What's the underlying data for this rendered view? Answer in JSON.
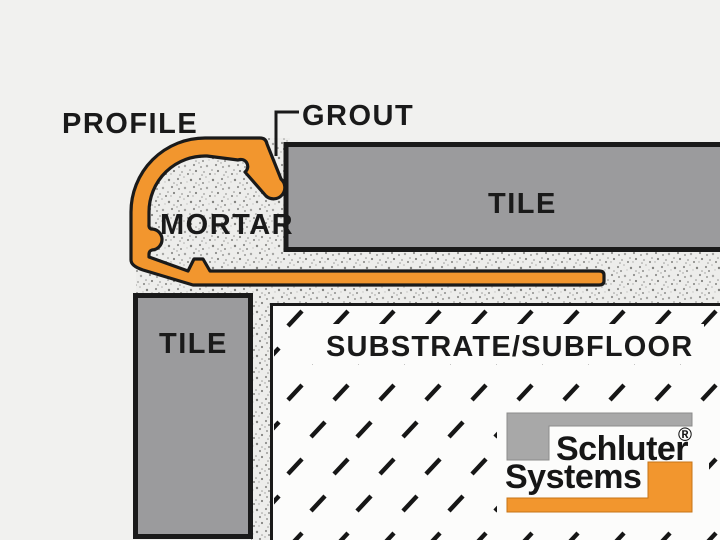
{
  "title": "Tile edge profile installation cross-section diagram",
  "labels": {
    "profile": "PROFILE",
    "grout": "GROUT",
    "mortar": "MORTAR",
    "tile_top": "TILE",
    "tile_left": "TILE",
    "substrate": "SUBSTRATE/SUBFLOOR"
  },
  "logo": {
    "line1": "Schluter",
    "line2": "Systems",
    "registered_mark": "®"
  },
  "colors": {
    "background": "#F1F1EF",
    "accent_orange": "#F2962E",
    "tile_gray": "#9B9B9D",
    "logo_gray": "#A8A8A8",
    "outline_black": "#1A1A1A",
    "substrate_white": "#FCFCFB",
    "mortar_base": "#EDEDEB"
  }
}
